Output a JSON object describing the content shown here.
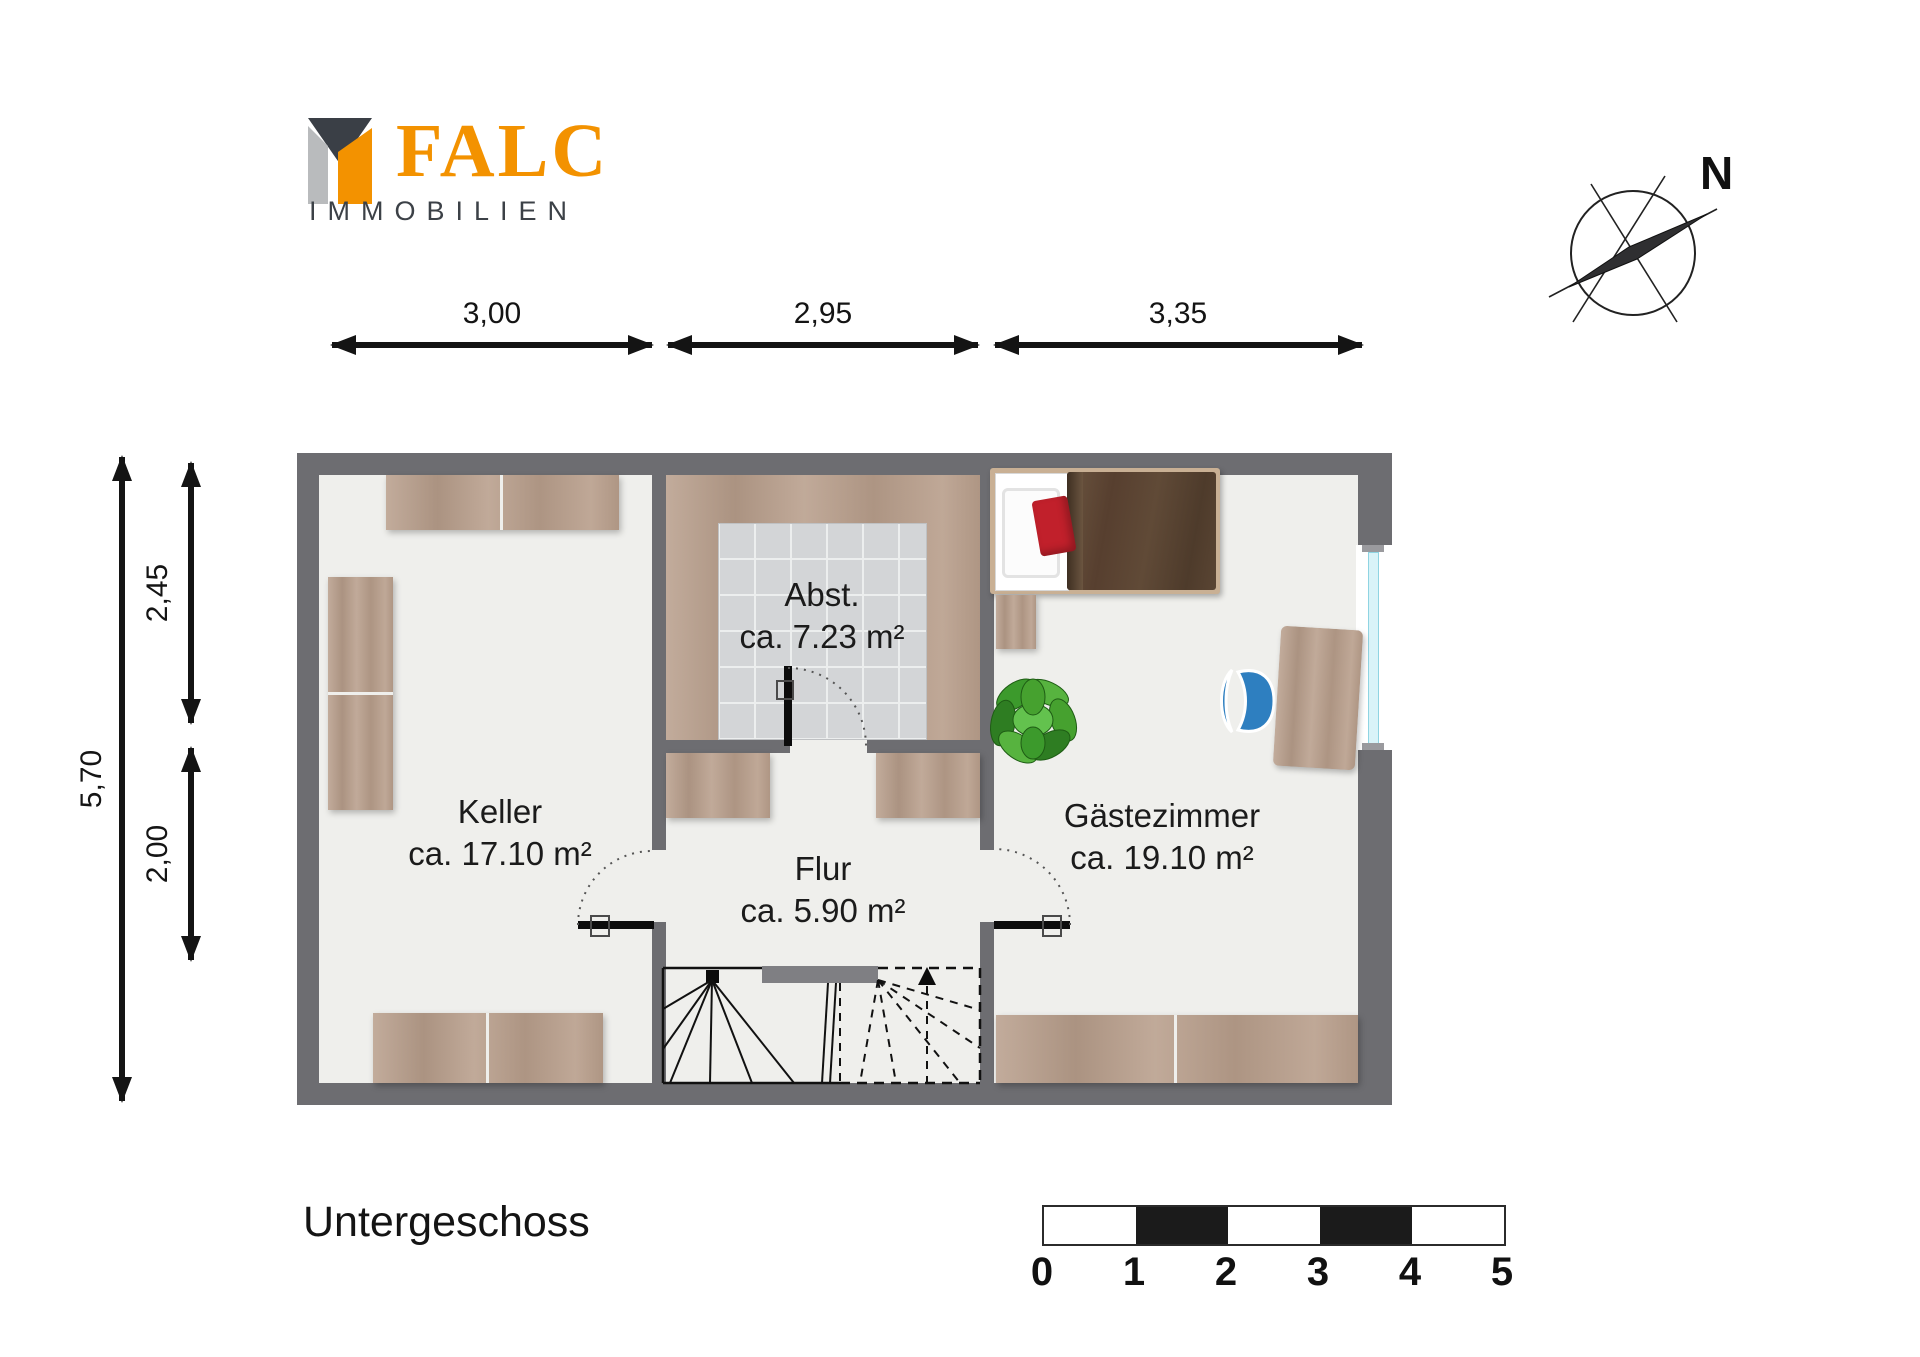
{
  "logo": {
    "name": "FALC",
    "subtitle": "IMMOBILIEN",
    "colors": {
      "orange": "#f39200",
      "dark_gray": "#3a3f46",
      "light_gray": "#b9bbbd"
    }
  },
  "compass": {
    "north_label": "N"
  },
  "dimensions": {
    "top": [
      "3,00",
      "2,95",
      "3,35"
    ],
    "left": [
      "5,70",
      "2,45",
      "2,00"
    ]
  },
  "rooms": {
    "keller": {
      "name": "Keller",
      "area": "ca. 17.10 m²"
    },
    "abstellraum": {
      "name": "Abst.",
      "area": "ca. 7.23 m²"
    },
    "flur": {
      "name": "Flur",
      "area": "ca. 5.90 m²"
    },
    "gaestezimmer": {
      "name": "Gästezimmer",
      "area": "ca. 19.10 m²"
    }
  },
  "floor_label": "Untergeschoss",
  "scale_bar": {
    "labels": [
      "0",
      "1",
      "2",
      "3",
      "4",
      "5"
    ]
  },
  "colors": {
    "wall": "#6d6d71",
    "floor": "#efefec",
    "wood": "#b89e8b",
    "tile": "#d3d5d7",
    "window_glass": "#d9f3f8",
    "bed_blanket": "#5a4533",
    "pillow_red": "#c1202b",
    "chair_blue": "#2e7fc0",
    "plant_green": "#46a12f"
  }
}
